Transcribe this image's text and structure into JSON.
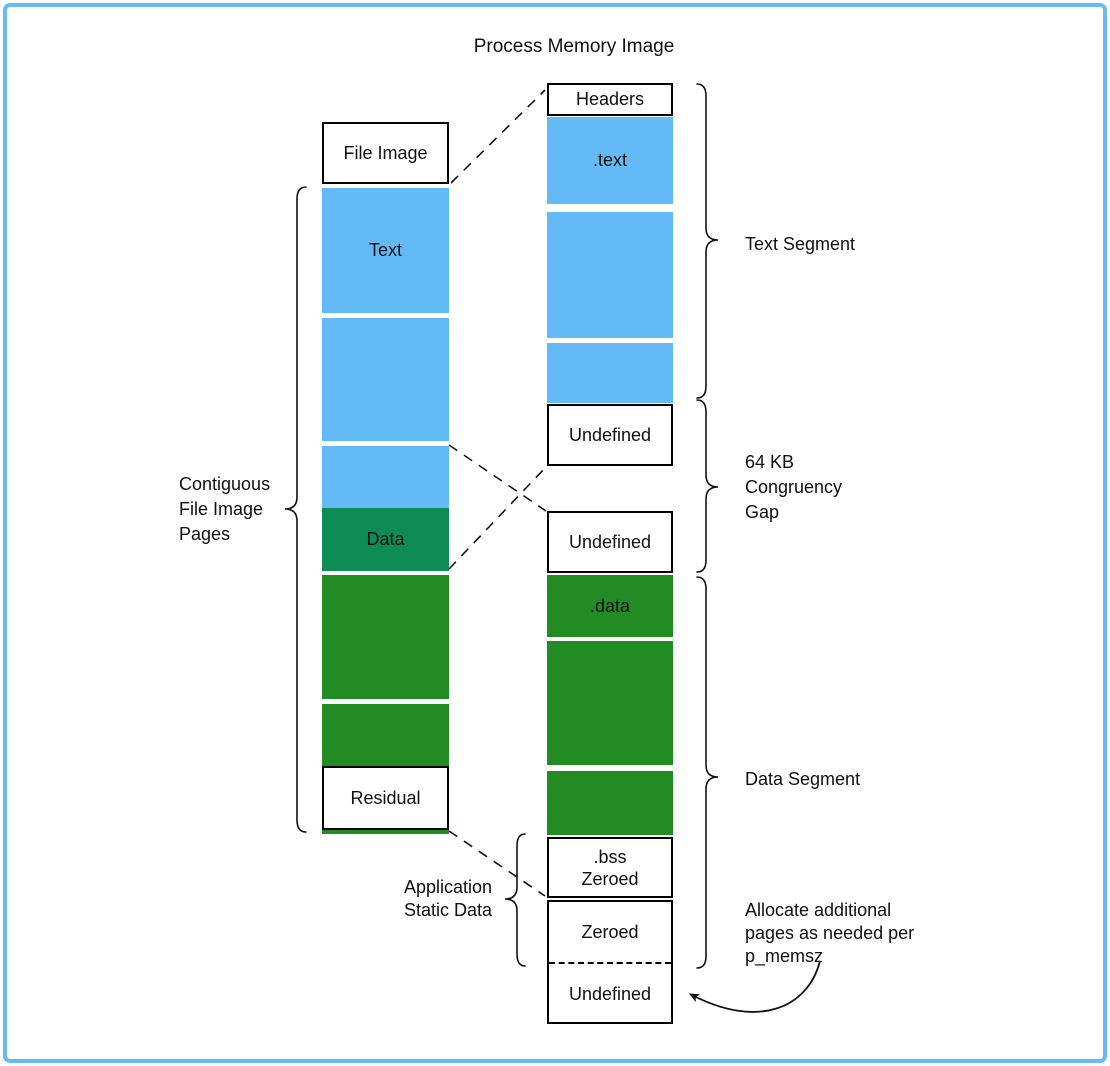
{
  "title": "Process Memory Image",
  "file_column": {
    "file_image_label": "File Image",
    "text_block_label": "Text",
    "data_block_label": "Data",
    "residual_label": "Residual"
  },
  "memory_column": {
    "headers_label": "Headers",
    "text_section_label": ".text",
    "undefined_label_1": "Undefined",
    "undefined_label_2": "Undefined",
    "data_section_label": ".data",
    "bss_label_line1": ".bss",
    "bss_label_line2": "Zeroed",
    "zeroed_label": "Zeroed",
    "undefined_label_3": "Undefined"
  },
  "annotations": {
    "contiguous_lines": [
      "Contiguous",
      "File Image",
      "Pages"
    ],
    "app_static_lines": [
      "Application",
      "Static Data"
    ],
    "text_segment": "Text Segment",
    "congruency_lines": [
      "64 KB",
      "Congruency",
      "Gap"
    ],
    "data_segment": "Data Segment",
    "allocate_lines": [
      "Allocate additional",
      "pages as needed per",
      "p_memsz"
    ]
  },
  "colors": {
    "page_blue": "#64B9F7",
    "data_teal": "#0E8C56",
    "data_green": "#238B23",
    "frame_blue": "#66BBF7",
    "ink": "#111111"
  }
}
